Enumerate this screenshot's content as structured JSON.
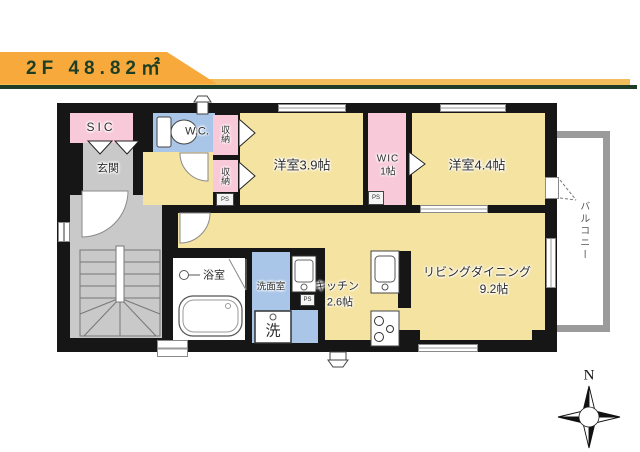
{
  "header": {
    "floor_label": "2F 48.82㎡",
    "banner_color": "#F7A93C",
    "banner_strip_color": "#F2BE5C",
    "banner_line_color": "#1E3D26"
  },
  "plan": {
    "wall_color": "#161616",
    "room_colors": {
      "yellow": "#F4E3A1",
      "pink": "#F8C9D9",
      "blue": "#A9C5E8",
      "gray": "#C9C9C9"
    },
    "rooms": {
      "sic": {
        "label": "SIC"
      },
      "genkan": {
        "label": "玄関"
      },
      "wc": {
        "label": "W.C."
      },
      "storage_upper": {
        "label": "収納"
      },
      "storage_lower": {
        "label": "収納"
      },
      "bedroom_39": {
        "label": "洋室3.9帖"
      },
      "wic": {
        "label": "WIC",
        "size": "1帖"
      },
      "bedroom_44": {
        "label": "洋室4.4帖"
      },
      "bathroom": {
        "label": "浴室"
      },
      "washroom": {
        "label": "洗面室"
      },
      "washer": {
        "label": "洗"
      },
      "kitchen": {
        "label": "キッチン",
        "size": "2.6帖"
      },
      "living_dining": {
        "label": "リビングダイニング",
        "size": "9.2帖"
      },
      "balcony": {
        "label": "バルコニー"
      }
    },
    "ps_label": "PS"
  },
  "compass": {
    "north_label": "N"
  }
}
